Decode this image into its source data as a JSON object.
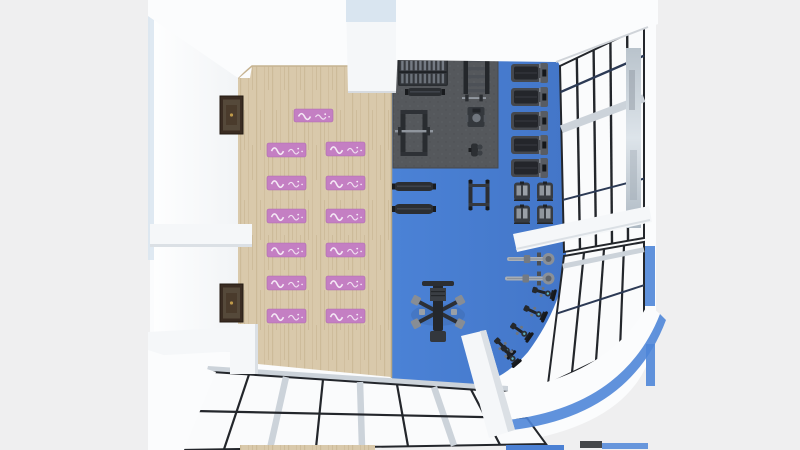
{
  "app": {
    "type": "3d-interior-render",
    "subject": "gym floor plan top-down view"
  },
  "palette": {
    "background": "#efeff0",
    "building_white": "#fbfcfd",
    "wall_beam_white": "#f5f7f9",
    "beam_shadow": "#dbe0e5",
    "accent_light_blue": "#d9e5f0",
    "wood_floor": "#d9c9ab",
    "wood_plank_dark": "#c6b391",
    "blue_floor": "#4b80d3",
    "rubber_mat": "#55585c",
    "yoga_mat_pink": "#c47fc3",
    "mat_pattern_white": "#f7eef8",
    "equipment_dark": "#26292d",
    "equipment_mid": "#3c4046",
    "equipment_light": "#8d939b",
    "window_frame": "#23262b",
    "window_glass": "#fafbfc",
    "window_mullion_silver": "#ccd3da",
    "window_bar_navy": "#2c3a55",
    "corner_accent_blue": "#4f86d8",
    "frame_brown": "#3a2c22",
    "bike_accent_teal": "#5fb3c4"
  },
  "scene": {
    "zones": [
      {
        "id": "yoga-zone",
        "floor": "wood",
        "mat_count": 13
      },
      {
        "id": "free-weights-zone",
        "floor": "rubber-mat"
      },
      {
        "id": "cardio-zone",
        "floor": "blue"
      }
    ],
    "yoga_mats": [
      {
        "x": 294,
        "y": 109,
        "w": 39,
        "h": 13
      },
      {
        "x": 267,
        "y": 143,
        "w": 39,
        "h": 14
      },
      {
        "x": 267,
        "y": 176,
        "w": 39,
        "h": 14
      },
      {
        "x": 267,
        "y": 209,
        "w": 39,
        "h": 14
      },
      {
        "x": 267,
        "y": 243,
        "w": 39,
        "h": 14
      },
      {
        "x": 267,
        "y": 276,
        "w": 39,
        "h": 14
      },
      {
        "x": 267,
        "y": 309,
        "w": 39,
        "h": 14
      },
      {
        "x": 326,
        "y": 142,
        "w": 39,
        "h": 14
      },
      {
        "x": 326,
        "y": 176,
        "w": 39,
        "h": 14
      },
      {
        "x": 326,
        "y": 209,
        "w": 39,
        "h": 14
      },
      {
        "x": 326,
        "y": 243,
        "w": 39,
        "h": 14
      },
      {
        "x": 326,
        "y": 276,
        "w": 39,
        "h": 14
      },
      {
        "x": 326,
        "y": 309,
        "w": 39,
        "h": 14
      }
    ],
    "equipment": [
      {
        "type": "dumbbell-rack",
        "x": 398,
        "y": 58,
        "w": 50,
        "h": 28,
        "r": 0
      },
      {
        "type": "storage-rack",
        "x": 463,
        "y": 56,
        "w": 27,
        "h": 38,
        "r": 0
      },
      {
        "type": "flat-bench",
        "x": 405,
        "y": 86,
        "w": 40,
        "h": 12,
        "r": 0
      },
      {
        "type": "barbell",
        "x": 462,
        "y": 94,
        "w": 24,
        "h": 8,
        "r": 0
      },
      {
        "type": "seated-machine",
        "x": 465,
        "y": 106,
        "w": 22,
        "h": 22,
        "r": 0
      },
      {
        "type": "squat-rack",
        "x": 399,
        "y": 109,
        "w": 30,
        "h": 48,
        "r": 0
      },
      {
        "type": "weight-bench",
        "x": 467,
        "y": 142,
        "w": 16,
        "h": 16,
        "r": 0
      },
      {
        "type": "treadmill",
        "x": 511,
        "y": 62,
        "w": 38,
        "h": 22,
        "r": 0
      },
      {
        "type": "treadmill",
        "x": 511,
        "y": 86,
        "w": 38,
        "h": 22,
        "r": 0
      },
      {
        "type": "treadmill",
        "x": 511,
        "y": 110,
        "w": 38,
        "h": 22,
        "r": 0
      },
      {
        "type": "treadmill",
        "x": 511,
        "y": 134,
        "w": 38,
        "h": 22,
        "r": 0
      },
      {
        "type": "treadmill",
        "x": 511,
        "y": 157,
        "w": 38,
        "h": 22,
        "r": 0
      },
      {
        "type": "flat-bench",
        "x": 392,
        "y": 180,
        "w": 44,
        "h": 13,
        "r": 0
      },
      {
        "type": "flat-bench",
        "x": 392,
        "y": 202,
        "w": 44,
        "h": 14,
        "r": 0
      },
      {
        "type": "dip-station",
        "x": 465,
        "y": 178,
        "w": 28,
        "h": 34,
        "r": 0
      },
      {
        "type": "elliptical",
        "x": 512,
        "y": 181,
        "w": 20,
        "h": 21,
        "r": 0
      },
      {
        "type": "elliptical",
        "x": 535,
        "y": 181,
        "w": 20,
        "h": 21,
        "r": 0
      },
      {
        "type": "elliptical",
        "x": 512,
        "y": 204,
        "w": 20,
        "h": 21,
        "r": 0
      },
      {
        "type": "elliptical",
        "x": 535,
        "y": 204,
        "w": 20,
        "h": 21,
        "r": 0
      },
      {
        "type": "rower",
        "x": 507,
        "y": 252,
        "w": 48,
        "h": 14,
        "r": 0
      },
      {
        "type": "rower",
        "x": 505,
        "y": 271,
        "w": 50,
        "h": 15,
        "r": 0
      },
      {
        "type": "multi-gym",
        "x": 407,
        "y": 279,
        "w": 62,
        "h": 66,
        "r": 0
      },
      {
        "type": "spin-bike",
        "x": 531,
        "y": 286,
        "w": 26,
        "h": 13,
        "r": 15
      },
      {
        "type": "spin-bike",
        "x": 522,
        "y": 306,
        "w": 26,
        "h": 13,
        "r": 25
      },
      {
        "type": "spin-bike",
        "x": 508,
        "y": 325,
        "w": 26,
        "h": 13,
        "r": 35
      },
      {
        "type": "spin-bike",
        "x": 491,
        "y": 341,
        "w": 26,
        "h": 13,
        "r": 45
      },
      {
        "type": "spin-bike",
        "x": 497,
        "y": 349,
        "w": 26,
        "h": 13,
        "r": 50
      }
    ],
    "wall_art": [
      {
        "type": "picture-frame",
        "x": 220,
        "y": 96,
        "w": 23,
        "h": 38
      },
      {
        "type": "picture-frame",
        "x": 220,
        "y": 284,
        "w": 23,
        "h": 38
      }
    ]
  }
}
